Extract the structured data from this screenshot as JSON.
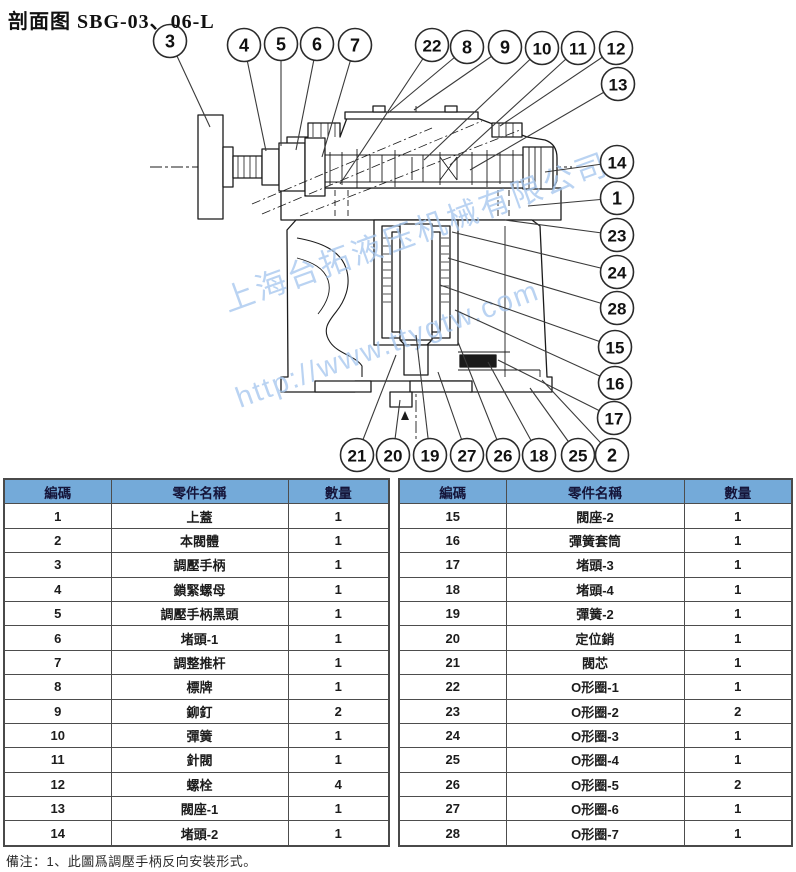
{
  "title": "剖面图 SBG-03、06-L",
  "note": "備注：1、此圖爲調壓手柄反向安裝形式。",
  "watermark": {
    "company": "上海台拓液压机械有限公司",
    "url": "http://www.ttygtw.com"
  },
  "colors": {
    "table_header_bg": "#74aad9",
    "drawing_line": "#1b1b1b",
    "watermark_blue": "#a9c9ef",
    "leader_line": "#3a3a3a"
  },
  "table_headers": [
    "編碼",
    "零件名稱",
    "數量"
  ],
  "parts_left": [
    [
      "1",
      "上蓋",
      "1"
    ],
    [
      "2",
      "本閥體",
      "1"
    ],
    [
      "3",
      "調壓手柄",
      "1"
    ],
    [
      "4",
      "鎖緊螺母",
      "1"
    ],
    [
      "5",
      "調壓手柄黑頭",
      "1"
    ],
    [
      "6",
      "堵頭-1",
      "1"
    ],
    [
      "7",
      "調整推杆",
      "1"
    ],
    [
      "8",
      "標牌",
      "1"
    ],
    [
      "9",
      "鉚釘",
      "2"
    ],
    [
      "10",
      "彈簧",
      "1"
    ],
    [
      "11",
      "針閥",
      "1"
    ],
    [
      "12",
      "螺栓",
      "4"
    ],
    [
      "13",
      "閥座-1",
      "1"
    ],
    [
      "14",
      "堵頭-2",
      "1"
    ]
  ],
  "parts_right": [
    [
      "15",
      "閥座-2",
      "1"
    ],
    [
      "16",
      "彈簧套筒",
      "1"
    ],
    [
      "17",
      "堵頭-3",
      "1"
    ],
    [
      "18",
      "堵頭-4",
      "1"
    ],
    [
      "19",
      "彈簧-2",
      "1"
    ],
    [
      "20",
      "定位銷",
      "1"
    ],
    [
      "21",
      "閥芯",
      "1"
    ],
    [
      "22",
      "O形圈-1",
      "1"
    ],
    [
      "23",
      "O形圈-2",
      "2"
    ],
    [
      "24",
      "O形圈-3",
      "1"
    ],
    [
      "25",
      "O形圈-4",
      "1"
    ],
    [
      "26",
      "O形圈-5",
      "2"
    ],
    [
      "27",
      "O形圈-6",
      "1"
    ],
    [
      "28",
      "O形圈-7",
      "1"
    ]
  ],
  "callouts": [
    {
      "n": "3",
      "cx": 170,
      "cy": 41,
      "tx": 210,
      "ty": 127
    },
    {
      "n": "4",
      "cx": 244,
      "cy": 45,
      "tx": 266,
      "ty": 151
    },
    {
      "n": "5",
      "cx": 281,
      "cy": 44,
      "tx": 281,
      "ty": 146
    },
    {
      "n": "6",
      "cx": 317,
      "cy": 44,
      "tx": 296,
      "ty": 150
    },
    {
      "n": "7",
      "cx": 355,
      "cy": 45,
      "tx": 322,
      "ty": 157
    },
    {
      "n": "22",
      "cx": 432,
      "cy": 45,
      "tx": 340,
      "ty": 184
    },
    {
      "n": "8",
      "cx": 467,
      "cy": 47,
      "tx": 388,
      "ty": 113
    },
    {
      "n": "9",
      "cx": 505,
      "cy": 47,
      "tx": 414,
      "ty": 110
    },
    {
      "n": "10",
      "cx": 542,
      "cy": 48,
      "tx": 424,
      "ty": 160
    },
    {
      "n": "11",
      "cx": 578,
      "cy": 48,
      "tx": 450,
      "ty": 165
    },
    {
      "n": "12",
      "cx": 616,
      "cy": 48,
      "tx": 500,
      "ty": 126
    },
    {
      "n": "13",
      "cx": 618,
      "cy": 84,
      "tx": 470,
      "ty": 170
    },
    {
      "n": "14",
      "cx": 617,
      "cy": 162,
      "tx": 545,
      "ty": 172
    },
    {
      "n": "1",
      "cx": 617,
      "cy": 198,
      "tx": 528,
      "ty": 206
    },
    {
      "n": "23",
      "cx": 617,
      "cy": 235,
      "tx": 505,
      "ty": 220
    },
    {
      "n": "24",
      "cx": 617,
      "cy": 272,
      "tx": 452,
      "ty": 232
    },
    {
      "n": "28",
      "cx": 617,
      "cy": 308,
      "tx": 448,
      "ty": 258
    },
    {
      "n": "15",
      "cx": 615,
      "cy": 347,
      "tx": 440,
      "ty": 285
    },
    {
      "n": "16",
      "cx": 615,
      "cy": 383,
      "tx": 455,
      "ty": 310
    },
    {
      "n": "17",
      "cx": 614,
      "cy": 418,
      "tx": 498,
      "ty": 360
    },
    {
      "n": "21",
      "cx": 357,
      "cy": 455,
      "tx": 396,
      "ty": 355
    },
    {
      "n": "20",
      "cx": 393,
      "cy": 455,
      "tx": 400,
      "ty": 400
    },
    {
      "n": "19",
      "cx": 430,
      "cy": 455,
      "tx": 416,
      "ty": 335
    },
    {
      "n": "27",
      "cx": 467,
      "cy": 455,
      "tx": 438,
      "ty": 372
    },
    {
      "n": "26",
      "cx": 503,
      "cy": 455,
      "tx": 458,
      "ty": 342
    },
    {
      "n": "18",
      "cx": 539,
      "cy": 455,
      "tx": 488,
      "ty": 362
    },
    {
      "n": "25",
      "cx": 578,
      "cy": 455,
      "tx": 530,
      "ty": 388
    },
    {
      "n": "2",
      "cx": 612,
      "cy": 455,
      "tx": 542,
      "ty": 380
    }
  ]
}
